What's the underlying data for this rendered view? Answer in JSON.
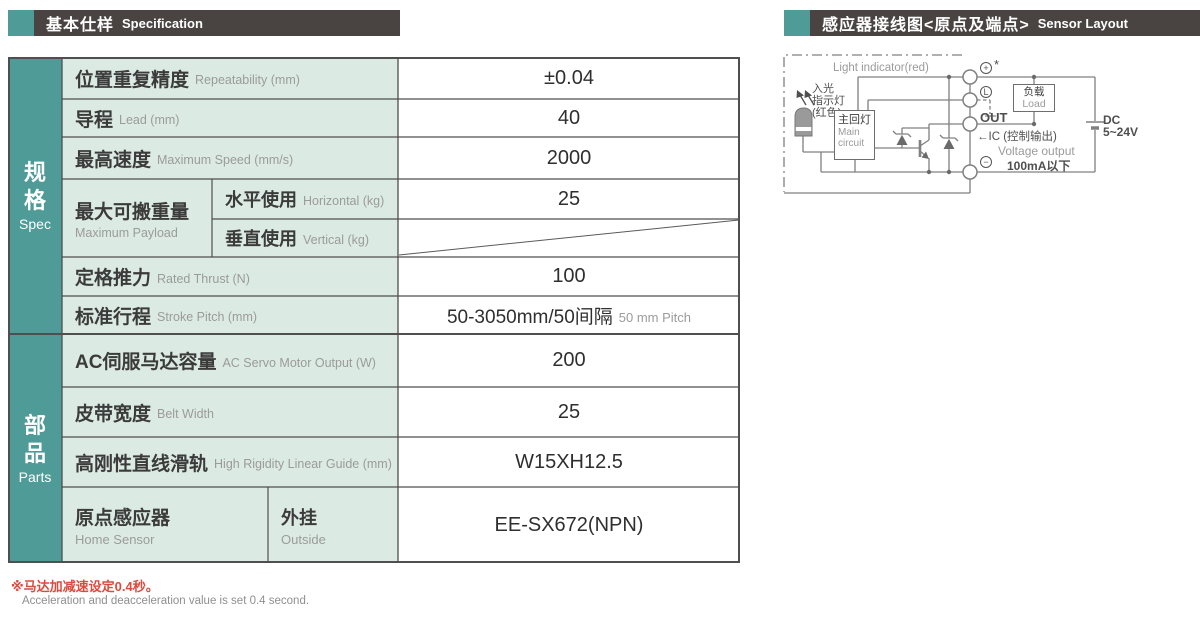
{
  "headers": {
    "left": {
      "zh": "基本仕样",
      "en": "Specification"
    },
    "right": {
      "zh": "感应器接线图<原点及端点>",
      "en": "Sensor Layout"
    }
  },
  "table": {
    "spec_section": {
      "zh": "规格",
      "en": "Spec"
    },
    "parts_section": {
      "zh": "部品",
      "en": "Parts"
    },
    "repeatability": {
      "zh": "位置重复精度",
      "en": "Repeatability (mm)",
      "value": "±0.04"
    },
    "lead": {
      "zh": "导程",
      "en": "Lead (mm)",
      "value": "40"
    },
    "max_speed": {
      "zh": "最高速度",
      "en": "Maximum Speed (mm/s)",
      "value": "2000"
    },
    "payload": {
      "zh": "最大可搬重量",
      "en": "Maximum Payload",
      "horizontal": {
        "zh": "水平使用",
        "en": "Horizontal (kg)",
        "value": "25"
      },
      "vertical": {
        "zh": "垂直使用",
        "en": "Vertical (kg)",
        "value": ""
      }
    },
    "thrust": {
      "zh": "定格推力",
      "en": "Rated Thrust (N)",
      "value": "100"
    },
    "stroke": {
      "zh": "标准行程",
      "en": "Stroke Pitch (mm)",
      "value": "50-3050mm/50间隔",
      "value_en": "50 mm Pitch"
    },
    "motor": {
      "zh": "AC伺服马达容量",
      "en": "AC Servo Motor Output (W)",
      "value": "200"
    },
    "belt": {
      "zh": "皮带宽度",
      "en": "Belt Width",
      "value": "25"
    },
    "guide": {
      "zh": "高刚性直线滑轨",
      "en": "High Rigidity Linear Guide (mm)",
      "value": "W15XH12.5"
    },
    "home_sensor": {
      "zh": "原点感应器",
      "en": "Home Sensor",
      "mount_zh": "外挂",
      "mount_en": "Outside",
      "value": "EE-SX672(NPN)"
    }
  },
  "notes": {
    "zh": "※马达加减速设定0.4秒。",
    "en": "Acceleration and deacceleration value is set 0.4 second."
  },
  "diagram": {
    "light_indicator_en": "Light indicator(red)",
    "led_label_1": "入光",
    "led_label_2": "指示灯",
    "led_label_3": "(红色)",
    "main_circuit_zh": "主回灯",
    "main_circuit_en1": "Main",
    "main_circuit_en2": "circuit",
    "load_zh": "负载",
    "load_en": "Load",
    "terminal_plus": "+",
    "terminal_star": "*",
    "terminal_light": "L",
    "terminal_out": "OUT",
    "terminal_minus": "−",
    "ic_label": "←IC (控制输出)",
    "voltage_output": "Voltage output",
    "current_limit": "100mA以下",
    "dc_line1": "DC",
    "dc_line2": "5~24V"
  },
  "colors": {
    "teal": "#4F9B98",
    "mint": "#DCEAE4",
    "header_dark": "#494442",
    "table_border": "#4F4F4F",
    "note_red": "#DC4A3D",
    "circuit_gray": "#808080"
  }
}
